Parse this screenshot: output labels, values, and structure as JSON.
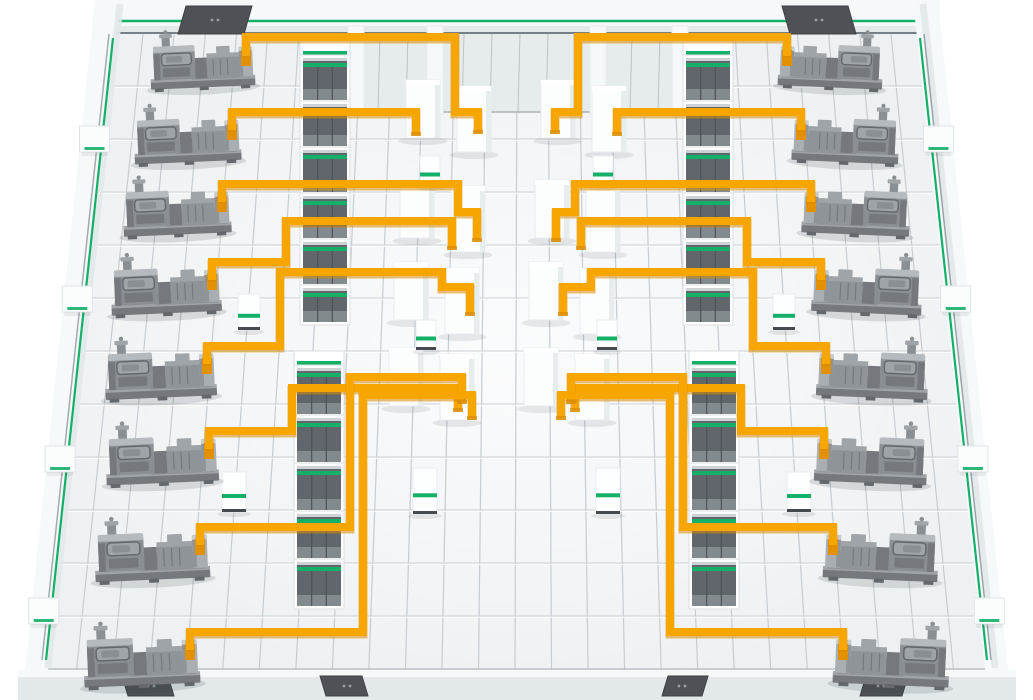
{
  "scene": {
    "description": "isometric-power-facility-floor-illustration",
    "colors": {
      "bg": "#ffffff",
      "floor": "#eef1f3",
      "grid_v": "#c6cdd2",
      "grid_h": "#cbd1d5",
      "grid_h_light": "#ffffff",
      "wall": "#f6f9fa",
      "wall_shade": "#e3e9eb",
      "wall_face": "#e6ebec",
      "wall_seam": "#bcc3c7",
      "wall_base_dark": "#778086",
      "accent_green": "#14b068",
      "cable_orange": "#f7a600",
      "cable_shadow": "#d88a00",
      "cable_end": "#e29104",
      "door_dark": "#4e5256",
      "door_dot": "#9aa0a4",
      "panel_frame": "#ffffff",
      "panel_edge": "#d9dfe2",
      "panel_interior": "#60666b",
      "panel_interior_light": "#828a8e",
      "panel_seam": "#4d5357",
      "panel_top_edge": "#ccd2d5",
      "column_fill": "#fcfdfd",
      "column_shade": "#e7eced",
      "column_stroke": "#e8edef",
      "shadow": "#2f3a42",
      "machine_body": "#8a8f93",
      "machine_light": "#b4babd",
      "machine_mid": "#9ea4a8",
      "machine_dark": "#75797d",
      "machine_darker": "#63686c",
      "machine_deck": "#8f9498",
      "machine_deck_top": "#b2b8bb",
      "machine_bracket": "#a9aeb2",
      "machine_bracket_top": "#c6cbce"
    },
    "floor": {
      "polygon": [
        [
          112,
          32
        ],
        [
          922,
          32
        ],
        [
          990,
          670
        ],
        [
          40,
          670
        ]
      ],
      "vertical_line_count": 27,
      "h_line_start": 86,
      "h_line_step": 53,
      "h_line_count": 12
    },
    "top_wall": {
      "band": [
        95,
        0,
        845,
        33
      ],
      "green_line_y": 21,
      "base_line_y": 33,
      "riser_face": {
        "x1": 352,
        "x2": 688,
        "y1": 33,
        "y2": 112,
        "seam_step": 28
      },
      "pillars": [
        [
          348,
          26,
          16,
          88
        ],
        [
          427,
          26,
          16,
          88
        ],
        [
          590,
          26,
          16,
          88
        ],
        [
          672,
          26,
          16,
          88
        ]
      ],
      "doors": [
        {
          "x": 186,
          "y": 6,
          "w": 66,
          "h": 28,
          "skew": -8
        },
        {
          "x": 782,
          "y": 6,
          "w": 66,
          "h": 28,
          "skew": 8
        }
      ]
    },
    "left_wall": {
      "outer": [
        [
          95,
          0
        ],
        [
          120,
          0
        ],
        [
          48,
          670
        ],
        [
          25,
          670
        ]
      ],
      "green_top": [
        113,
        38
      ],
      "green_bottom": [
        46,
        660
      ],
      "stub_ys": [
        126,
        286,
        446,
        598
      ],
      "stub_w": 30,
      "stub_h": 26
    },
    "right_wall": {
      "outer": [
        [
          913,
          0
        ],
        [
          938,
          0
        ],
        [
          1008,
          670
        ],
        [
          985,
          670
        ]
      ],
      "green_top": [
        920,
        38
      ],
      "green_bottom": [
        987,
        660
      ],
      "stub_ys": [
        126,
        286,
        446,
        598
      ],
      "stub_w": 30,
      "stub_h": 26
    },
    "bottom_wall": {
      "y": 670,
      "h": 30,
      "doors": [
        {
          "x": 128,
          "y": 676,
          "w": 46,
          "h": 20,
          "skew": -6
        },
        {
          "x": 326,
          "y": 676,
          "w": 42,
          "h": 20,
          "skew": -6
        },
        {
          "x": 662,
          "y": 676,
          "w": 40,
          "h": 20,
          "skew": 6
        },
        {
          "x": 860,
          "y": 676,
          "w": 42,
          "h": 20,
          "skew": 6
        }
      ]
    },
    "switchgear_rows": [
      {
        "id": "left-upper",
        "x": 303,
        "w": 44,
        "cells": [
          [
            58,
            42
          ],
          [
            104,
            42
          ],
          [
            150,
            42
          ],
          [
            196,
            42
          ],
          [
            242,
            42
          ],
          [
            288,
            34
          ]
        ]
      },
      {
        "id": "left-lower",
        "x": 297,
        "w": 44,
        "cells": [
          [
            368,
            46
          ],
          [
            418,
            44
          ],
          [
            466,
            44
          ],
          [
            514,
            44
          ],
          [
            562,
            44
          ]
        ]
      },
      {
        "id": "right-upper",
        "x": 686,
        "w": 44,
        "cells": [
          [
            58,
            42
          ],
          [
            104,
            42
          ],
          [
            150,
            42
          ],
          [
            196,
            42
          ],
          [
            242,
            42
          ],
          [
            288,
            34
          ]
        ]
      },
      {
        "id": "right-lower",
        "x": 692,
        "w": 44,
        "cells": [
          [
            368,
            46
          ],
          [
            418,
            44
          ],
          [
            466,
            44
          ],
          [
            514,
            44
          ],
          [
            562,
            44
          ]
        ]
      }
    ],
    "columns": [
      [
        406,
        80,
        34,
        58
      ],
      [
        457,
        86,
        34,
        66
      ],
      [
        400,
        180,
        34,
        58
      ],
      [
        451,
        186,
        34,
        66
      ],
      [
        394,
        262,
        34,
        58
      ],
      [
        445,
        268,
        34,
        66
      ],
      [
        389,
        348,
        34,
        58
      ],
      [
        440,
        354,
        34,
        66
      ],
      [
        541,
        80,
        34,
        58
      ],
      [
        592,
        86,
        34,
        66
      ],
      [
        535,
        180,
        34,
        58
      ],
      [
        586,
        186,
        34,
        66
      ],
      [
        529,
        262,
        34,
        58
      ],
      [
        580,
        268,
        34,
        66
      ],
      [
        524,
        348,
        34,
        58
      ],
      [
        575,
        354,
        34,
        66
      ]
    ],
    "pedestals": [
      [
        420,
        156,
        20,
        30
      ],
      [
        593,
        156,
        20,
        30
      ],
      [
        416,
        320,
        20,
        30
      ],
      [
        597,
        320,
        20,
        30
      ],
      [
        413,
        468,
        24,
        46
      ],
      [
        596,
        468,
        24,
        46
      ],
      [
        238,
        294,
        22,
        36
      ],
      [
        773,
        294,
        22,
        36
      ],
      [
        222,
        472,
        24,
        40
      ],
      [
        787,
        472,
        24,
        40
      ]
    ],
    "machines": {
      "left": [
        {
          "attach": [
            246,
            54
          ],
          "scale": 0.9
        },
        {
          "attach": [
            232,
            128
          ],
          "scale": 0.92
        },
        {
          "attach": [
            222,
            200
          ],
          "scale": 0.93
        },
        {
          "attach": [
            212,
            278
          ],
          "scale": 0.95
        },
        {
          "attach": [
            207,
            362
          ],
          "scale": 0.96
        },
        {
          "attach": [
            209,
            447
          ],
          "scale": 0.97
        },
        {
          "attach": [
            200,
            543
          ],
          "scale": 0.99
        },
        {
          "attach": [
            190,
            648
          ],
          "scale": 1.0
        }
      ],
      "right": [
        {
          "attach": [
            787,
            54
          ],
          "scale": 0.9
        },
        {
          "attach": [
            801,
            128
          ],
          "scale": 0.92
        },
        {
          "attach": [
            811,
            200
          ],
          "scale": 0.93
        },
        {
          "attach": [
            821,
            278
          ],
          "scale": 0.95
        },
        {
          "attach": [
            826,
            362
          ],
          "scale": 0.96
        },
        {
          "attach": [
            824,
            447
          ],
          "scale": 0.97
        },
        {
          "attach": [
            833,
            543
          ],
          "scale": 0.99
        },
        {
          "attach": [
            843,
            648
          ],
          "scale": 1.0
        }
      ]
    },
    "cables": {
      "left": [
        [
          [
            246,
            56
          ],
          [
            246,
            37
          ],
          [
            455,
            37
          ],
          [
            455,
            112
          ],
          [
            478,
            112
          ],
          [
            478,
            132
          ]
        ],
        [
          [
            232,
            130
          ],
          [
            232,
            112
          ],
          [
            416,
            112
          ],
          [
            416,
            134
          ]
        ],
        [
          [
            222,
            202
          ],
          [
            222,
            184
          ],
          [
            458,
            184
          ],
          [
            458,
            212
          ],
          [
            477,
            212
          ],
          [
            477,
            240
          ]
        ],
        [
          [
            212,
            280
          ],
          [
            212,
            262
          ],
          [
            286,
            262
          ],
          [
            286,
            221
          ],
          [
            452,
            221
          ],
          [
            452,
            248
          ]
        ],
        [
          [
            207,
            364
          ],
          [
            207,
            346
          ],
          [
            280,
            346
          ],
          [
            280,
            272
          ],
          [
            442,
            272
          ],
          [
            442,
            287
          ],
          [
            470,
            287
          ],
          [
            470,
            314
          ]
        ],
        [
          [
            209,
            449
          ],
          [
            209,
            431
          ],
          [
            292,
            431
          ],
          [
            292,
            388
          ],
          [
            458,
            388
          ],
          [
            458,
            410
          ]
        ],
        [
          [
            200,
            545
          ],
          [
            200,
            527
          ],
          [
            350,
            527
          ],
          [
            350,
            377
          ],
          [
            462,
            377
          ],
          [
            462,
            402
          ]
        ],
        [
          [
            190,
            650
          ],
          [
            190,
            632
          ],
          [
            363,
            632
          ],
          [
            363,
            395
          ],
          [
            472,
            395
          ],
          [
            472,
            418
          ]
        ]
      ],
      "right": [
        [
          [
            787,
            56
          ],
          [
            787,
            37
          ],
          [
            578,
            37
          ],
          [
            578,
            112
          ],
          [
            555,
            112
          ],
          [
            555,
            132
          ]
        ],
        [
          [
            801,
            130
          ],
          [
            801,
            112
          ],
          [
            617,
            112
          ],
          [
            617,
            134
          ]
        ],
        [
          [
            811,
            202
          ],
          [
            811,
            184
          ],
          [
            575,
            184
          ],
          [
            575,
            212
          ],
          [
            556,
            212
          ],
          [
            556,
            240
          ]
        ],
        [
          [
            821,
            280
          ],
          [
            821,
            262
          ],
          [
            747,
            262
          ],
          [
            747,
            221
          ],
          [
            581,
            221
          ],
          [
            581,
            248
          ]
        ],
        [
          [
            826,
            364
          ],
          [
            826,
            346
          ],
          [
            753,
            346
          ],
          [
            753,
            272
          ],
          [
            591,
            272
          ],
          [
            591,
            287
          ],
          [
            563,
            287
          ],
          [
            563,
            314
          ]
        ],
        [
          [
            824,
            449
          ],
          [
            824,
            431
          ],
          [
            741,
            431
          ],
          [
            741,
            388
          ],
          [
            575,
            388
          ],
          [
            575,
            410
          ]
        ],
        [
          [
            833,
            545
          ],
          [
            833,
            527
          ],
          [
            683,
            527
          ],
          [
            683,
            377
          ],
          [
            571,
            377
          ],
          [
            571,
            402
          ]
        ],
        [
          [
            843,
            650
          ],
          [
            843,
            632
          ],
          [
            670,
            632
          ],
          [
            670,
            395
          ],
          [
            561,
            395
          ],
          [
            561,
            418
          ]
        ]
      ]
    }
  }
}
